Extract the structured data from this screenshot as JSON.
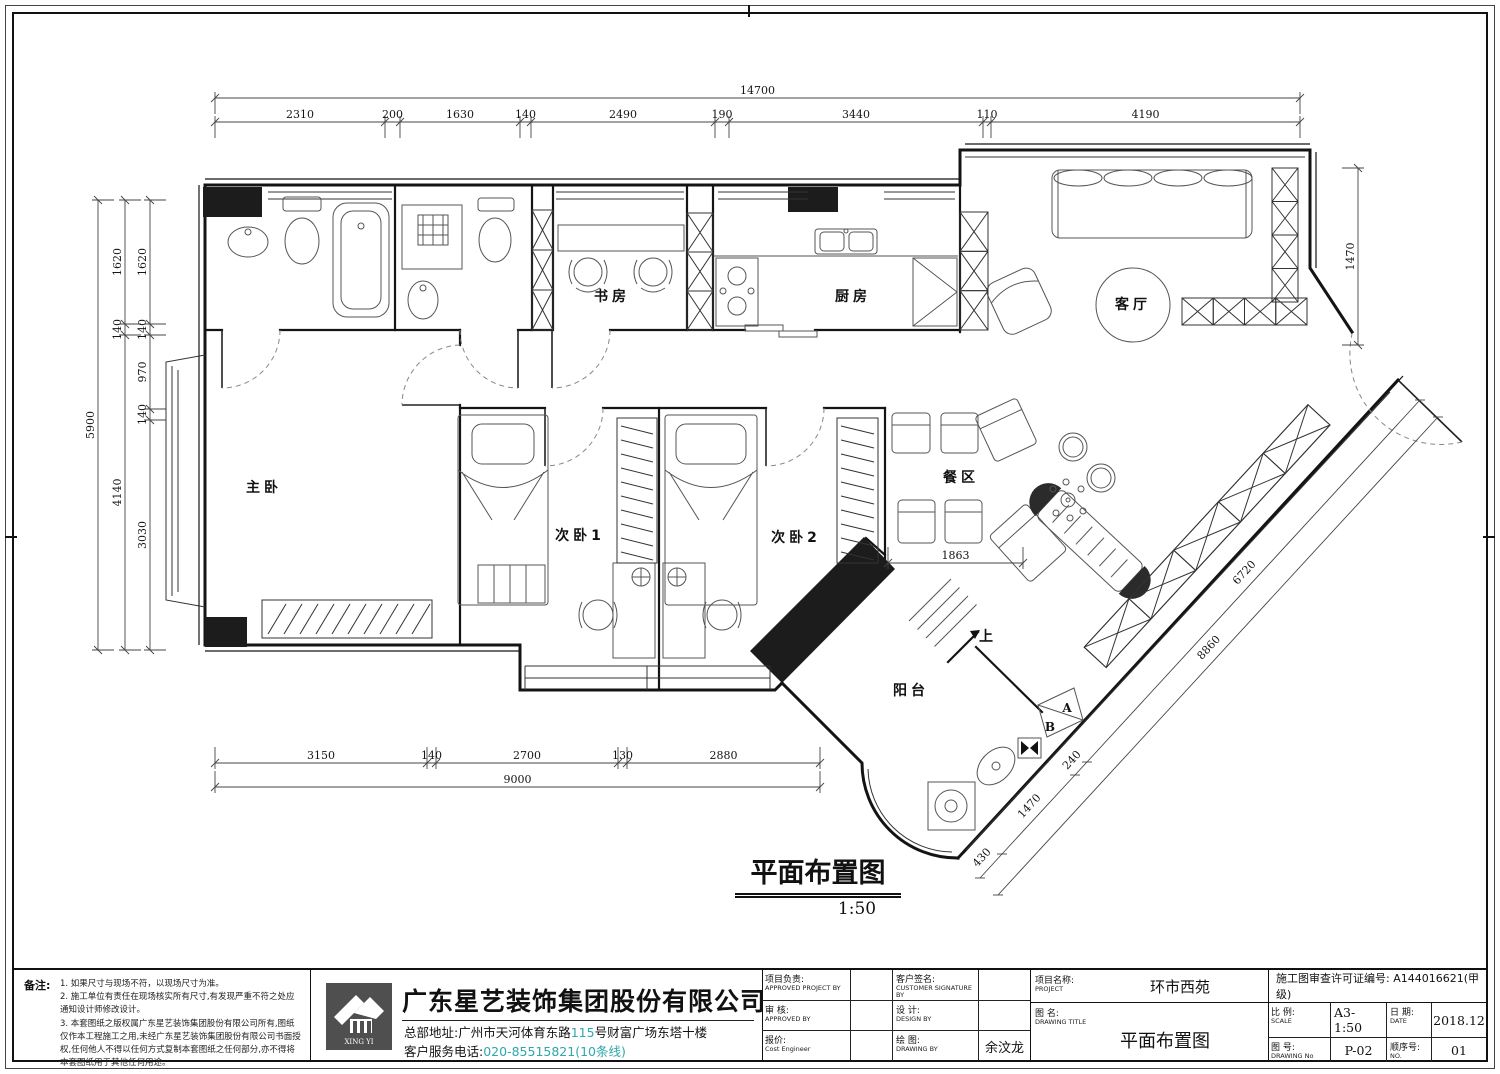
{
  "colors": {
    "accent_teal": "#2FA7AD",
    "line": "#1a1a1a",
    "logo_bg": "#4f4f4f"
  },
  "plan": {
    "title": "平面布置图",
    "scale": "1:50",
    "rooms": {
      "master_bedroom": "主卧",
      "bedroom_2": "次卧1",
      "bedroom_3": "次卧2",
      "study": "书房",
      "kitchen": "厨房",
      "living_room": "客厅",
      "dining_area": "餐区",
      "balcony": "阳台"
    },
    "labels": {
      "up": "上",
      "marker_a": "A",
      "marker_b": "B"
    },
    "dims": {
      "top_total": "14700",
      "top": [
        "2310",
        "200",
        "1630",
        "140",
        "2490",
        "190",
        "3440",
        "110",
        "4190"
      ],
      "left_total": "5900",
      "left_mid": [
        "1620",
        "140",
        "4140"
      ],
      "left_inner": [
        "1620",
        "140",
        "970",
        "140",
        "3030"
      ],
      "bottom": [
        "3150",
        "140",
        "2700",
        "130",
        "2880"
      ],
      "bottom_total": "9000",
      "right": "1470",
      "dining": "1863",
      "diag_outer": "8860",
      "diag_inner": [
        "6720",
        "240",
        "1470",
        "430"
      ]
    }
  },
  "titleblock": {
    "notes": {
      "label": "备注:",
      "items": [
        "1. 如果尺寸与现场不符，以现场尺寸为准。",
        "2. 施工单位有责任在现场核实所有尺寸,有发现严重不符之处应通知设计师修改设计。",
        "3. 本套图纸之版权属广东星艺装饰集团股份有限公司所有,图纸仅作本工程施工之用,未经广东星艺装饰集团股份有限公司书面授权,任何他人不得以任何方式复制本套图纸之任何部分,亦不得将本套图纸用于其他任何用途。"
      ]
    },
    "company": {
      "name": "广东星艺装饰集团股份有限公司",
      "logo_text": "XING YI",
      "address_prefix": "总部地址:广州市天河体育东路",
      "address_number": "115",
      "address_suffix": "号财富广场东塔十楼",
      "phone_label": "客户服务电话:",
      "phone_number": "020-85515821(10条线)",
      "website": "http://www.xingyigz.com.cn"
    },
    "approvals": {
      "project_lead": {
        "zh": "项目负责:",
        "en": "APPROVED PROJECT BY"
      },
      "customer_signature": {
        "zh": "客户签名:",
        "en": "CUSTOMER SIGNATURE BY"
      },
      "review": {
        "zh": "审 核:",
        "en": "APPROVED BY"
      },
      "design": {
        "zh": "设 计:",
        "en": "DESIGN BY"
      },
      "quote": {
        "zh": "报价:",
        "en": "Cost Engineer"
      },
      "drawing_by": {
        "zh": "绘 图:",
        "en": "DRAWING BY",
        "value": "余汶龙"
      }
    },
    "project": {
      "zh": "项目名称:",
      "en": "PROJECT",
      "value": "环市西苑"
    },
    "drawing_title": {
      "zh": "图 名:",
      "en": "DRAWING TITLE",
      "value": "平面布置图"
    },
    "license": "施工图审查许可证编号: A144016621(甲级)",
    "scale": {
      "zh": "比 例:",
      "en": "SCALE",
      "value": "A3-1:50"
    },
    "date": {
      "zh": "日 期:",
      "en": "DATE",
      "value": "2018.12"
    },
    "drawing_no": {
      "zh": "图 号:",
      "en": "DRAWING No",
      "value": "P-02"
    },
    "seq_no": {
      "zh": "顺序号:",
      "en": "NO.",
      "value": "01"
    }
  }
}
